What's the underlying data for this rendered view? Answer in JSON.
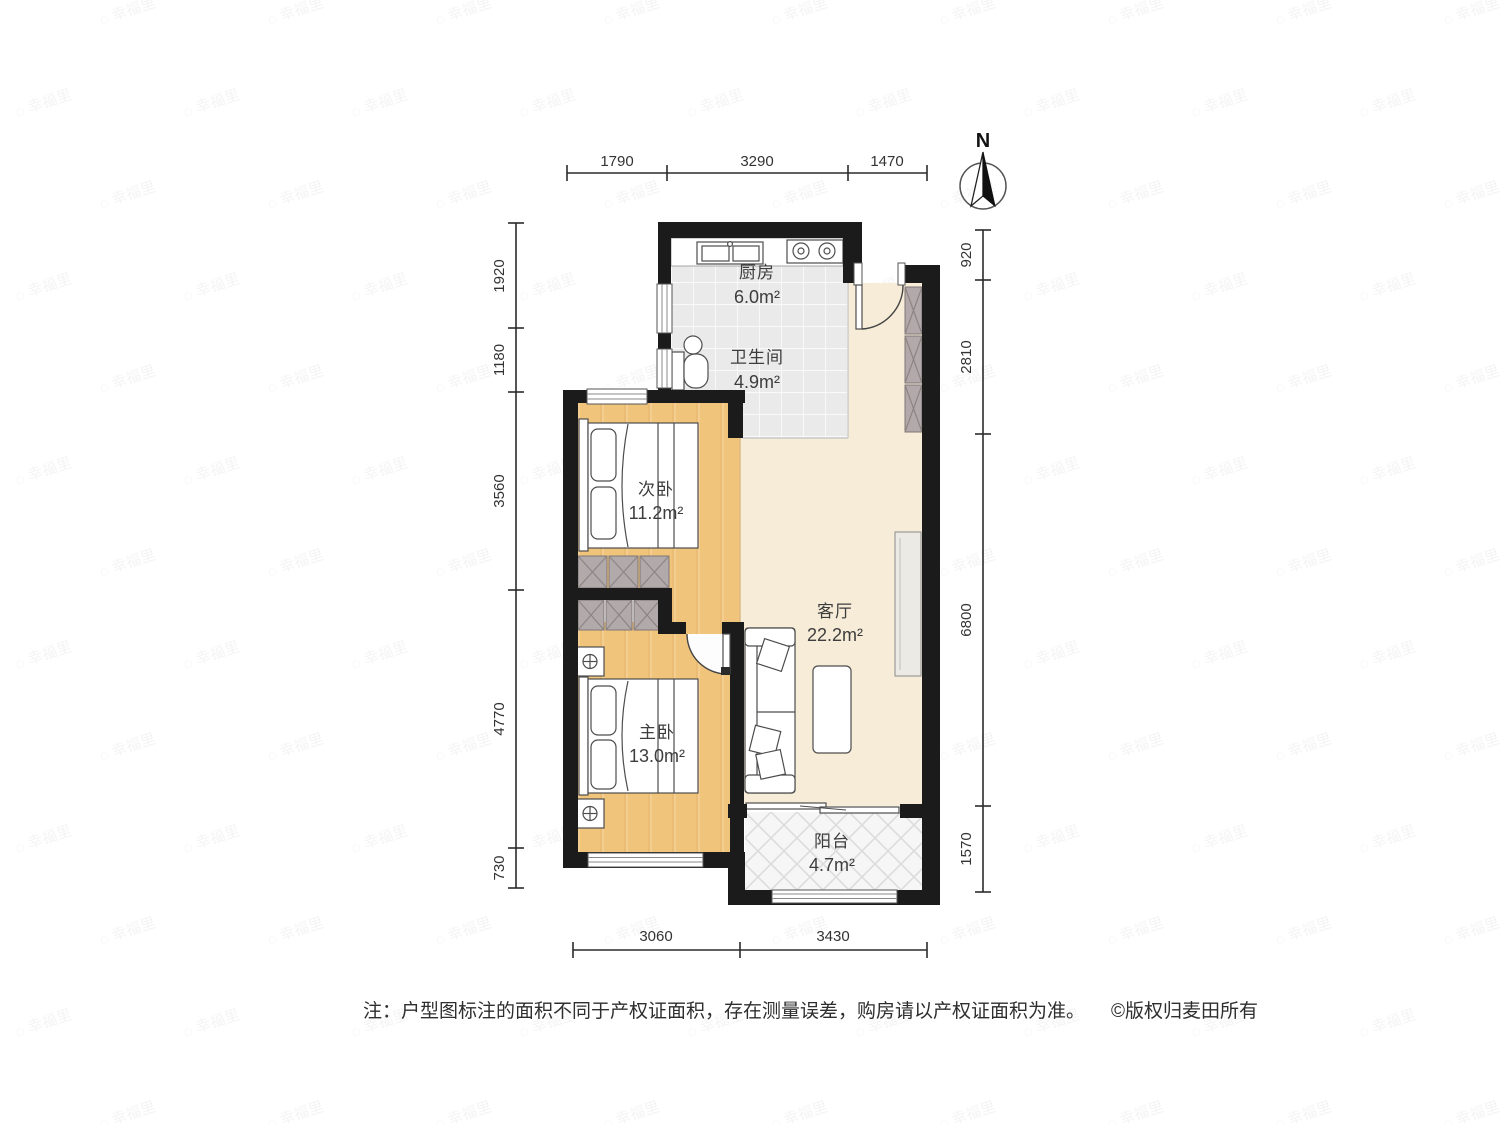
{
  "compass": {
    "label": "N"
  },
  "rooms": {
    "kitchen": {
      "name": "厨房",
      "area": "6.0m²"
    },
    "bathroom": {
      "name": "卫生间",
      "area": "4.9m²"
    },
    "secondary_bedroom": {
      "name": "次卧",
      "area": "11.2m²"
    },
    "living_room": {
      "name": "客厅",
      "area": "22.2m²"
    },
    "master_bedroom": {
      "name": "主卧",
      "area": "13.0m²"
    },
    "balcony": {
      "name": "阳台",
      "area": "4.7m²"
    }
  },
  "dimensions": {
    "top": [
      "1790",
      "3290",
      "1470"
    ],
    "left": [
      "1920",
      "1180",
      "3560",
      "4770",
      "730"
    ],
    "right": [
      "920",
      "2810",
      "6800",
      "1570"
    ],
    "bottom": [
      "3060",
      "3430"
    ]
  },
  "note": {
    "text": "注：户型图标注的面积不同于产权证面积，存在测量误差，购房请以产权证面积为准。",
    "copyright": "©版权归麦田所有"
  },
  "watermark": {
    "text": "幸福里"
  },
  "colors": {
    "wall": "#1b1b1b",
    "bedroom_floor": "#f1c47c",
    "living_floor": "#f6ecd8",
    "tile_floor": "#eaeaea",
    "balcony_floor": "#f6f6f6",
    "wardrobe": "#b2aaaa"
  }
}
